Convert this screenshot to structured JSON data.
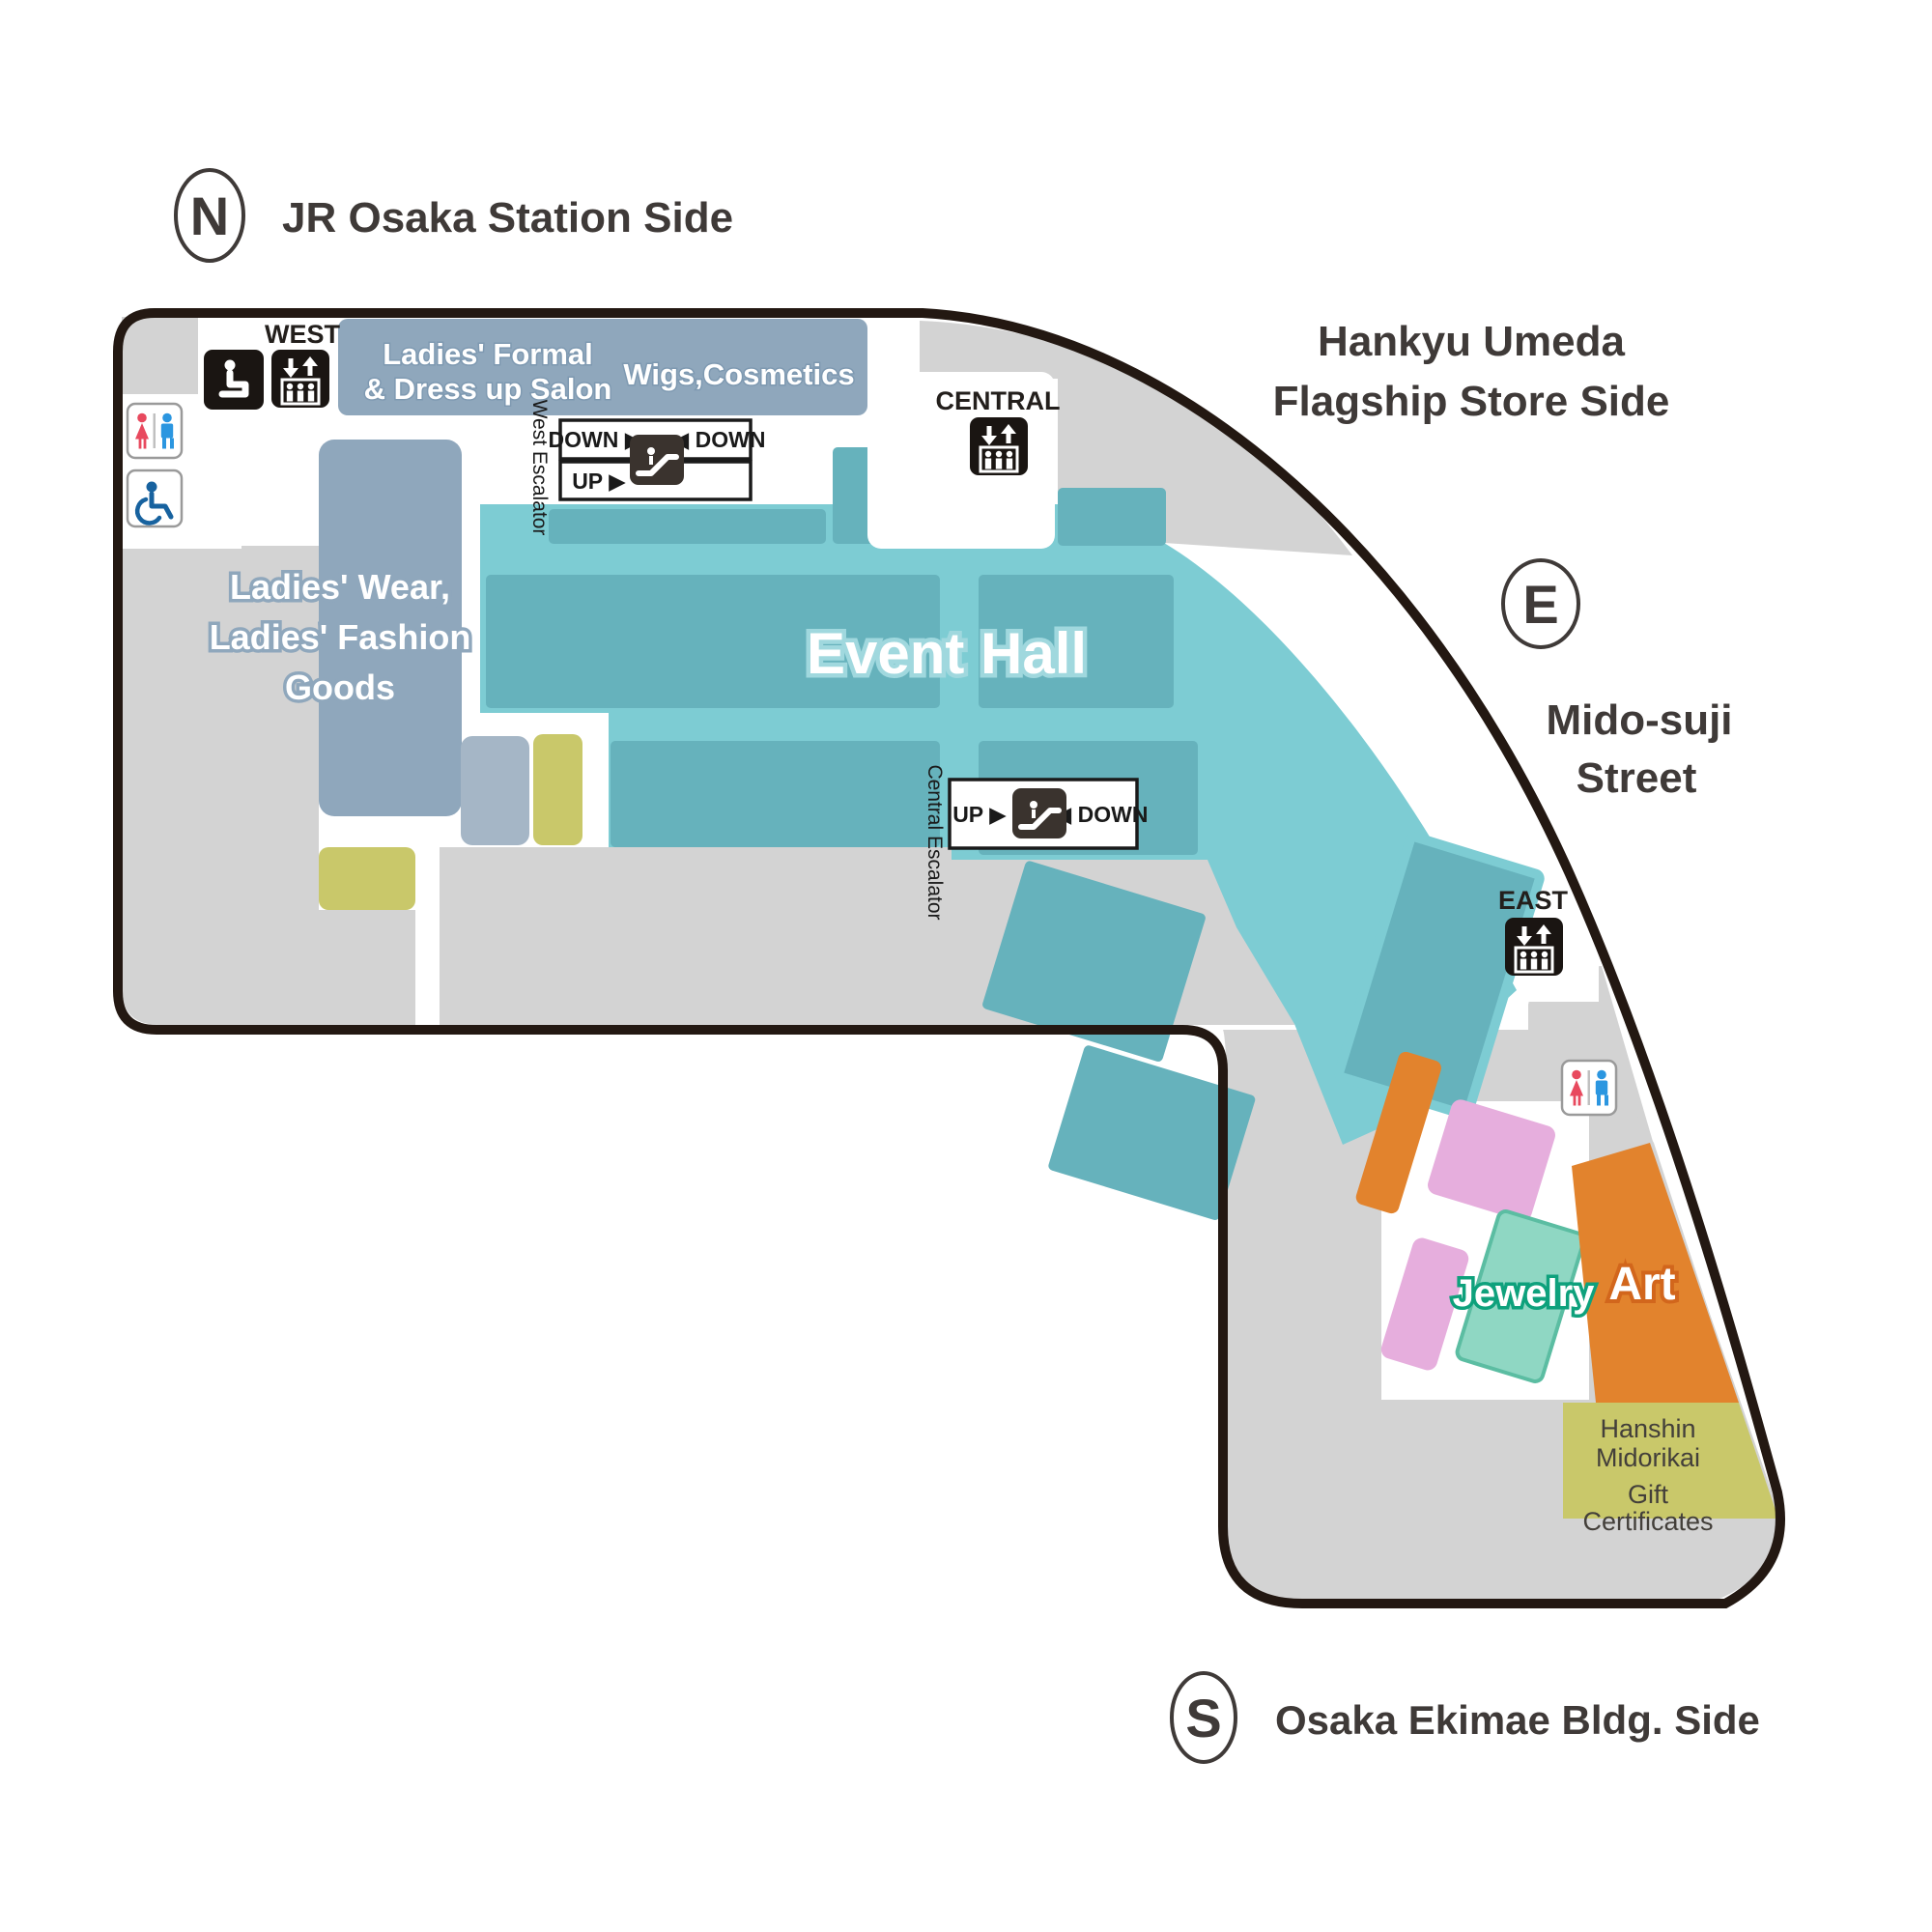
{
  "map_title": "Department store floor map",
  "compass": {
    "north": "N",
    "east": "E",
    "south": "S"
  },
  "surroundings": {
    "north_street": "JR Osaka Station Side",
    "northeast_line1": "Hankyu Umeda",
    "northeast_line2": "Flagship Store Side",
    "east_line1": "Mido-suji",
    "east_line2": "Street",
    "south_street": "Osaka Ekimae Bldg. Side"
  },
  "areas": {
    "event_hall": "Event Hall",
    "ladies_wear": {
      "line1": "Ladies' Wear,",
      "line2": "Ladies' Fashion",
      "line3": "Goods"
    },
    "ladies_formal": {
      "line1": "Ladies' Formal",
      "line2": "& Dress up Salon"
    },
    "wigs_cosmetics": "Wigs,Cosmetics",
    "jewelry": "Jewelry",
    "art": "Art",
    "gift_certificates": {
      "line1": "Hanshin",
      "line2": "Midorikai",
      "line3": "Gift",
      "line4": "Certificates"
    }
  },
  "elevators": {
    "west": "WEST",
    "central": "CENTRAL",
    "east": "EAST"
  },
  "escalators": {
    "west_label": "West Escalator",
    "central_label": "Central Escalator",
    "west_row1_left": "DOWN ▶",
    "west_row1_right": "◀ DOWN",
    "west_row2_left": "UP ▶",
    "central_left": "UP ▶",
    "central_right": "◀ DOWN"
  },
  "icons": {
    "legend": [
      "rest-seat-icon",
      "elevator-icon",
      "escalator-icon",
      "restroom-icon",
      "wheelchair-icon"
    ]
  },
  "colors": {
    "outline": "#231812",
    "floor_gray": "#d3d3d3",
    "teal_light": "#7dccd3",
    "teal_dark": "#66b2bc",
    "bluegray": "#8fa7bc",
    "bluegray_light": "#a5b6c6",
    "olive": "#c9c86a",
    "pink": "#e6aedd",
    "orange": "#e2832d",
    "jewelry_green": "#8fd7c3",
    "restroom_red": "#e8495e",
    "restroom_blue": "#2b96e0",
    "wheelchair_blue": "#17629f"
  }
}
